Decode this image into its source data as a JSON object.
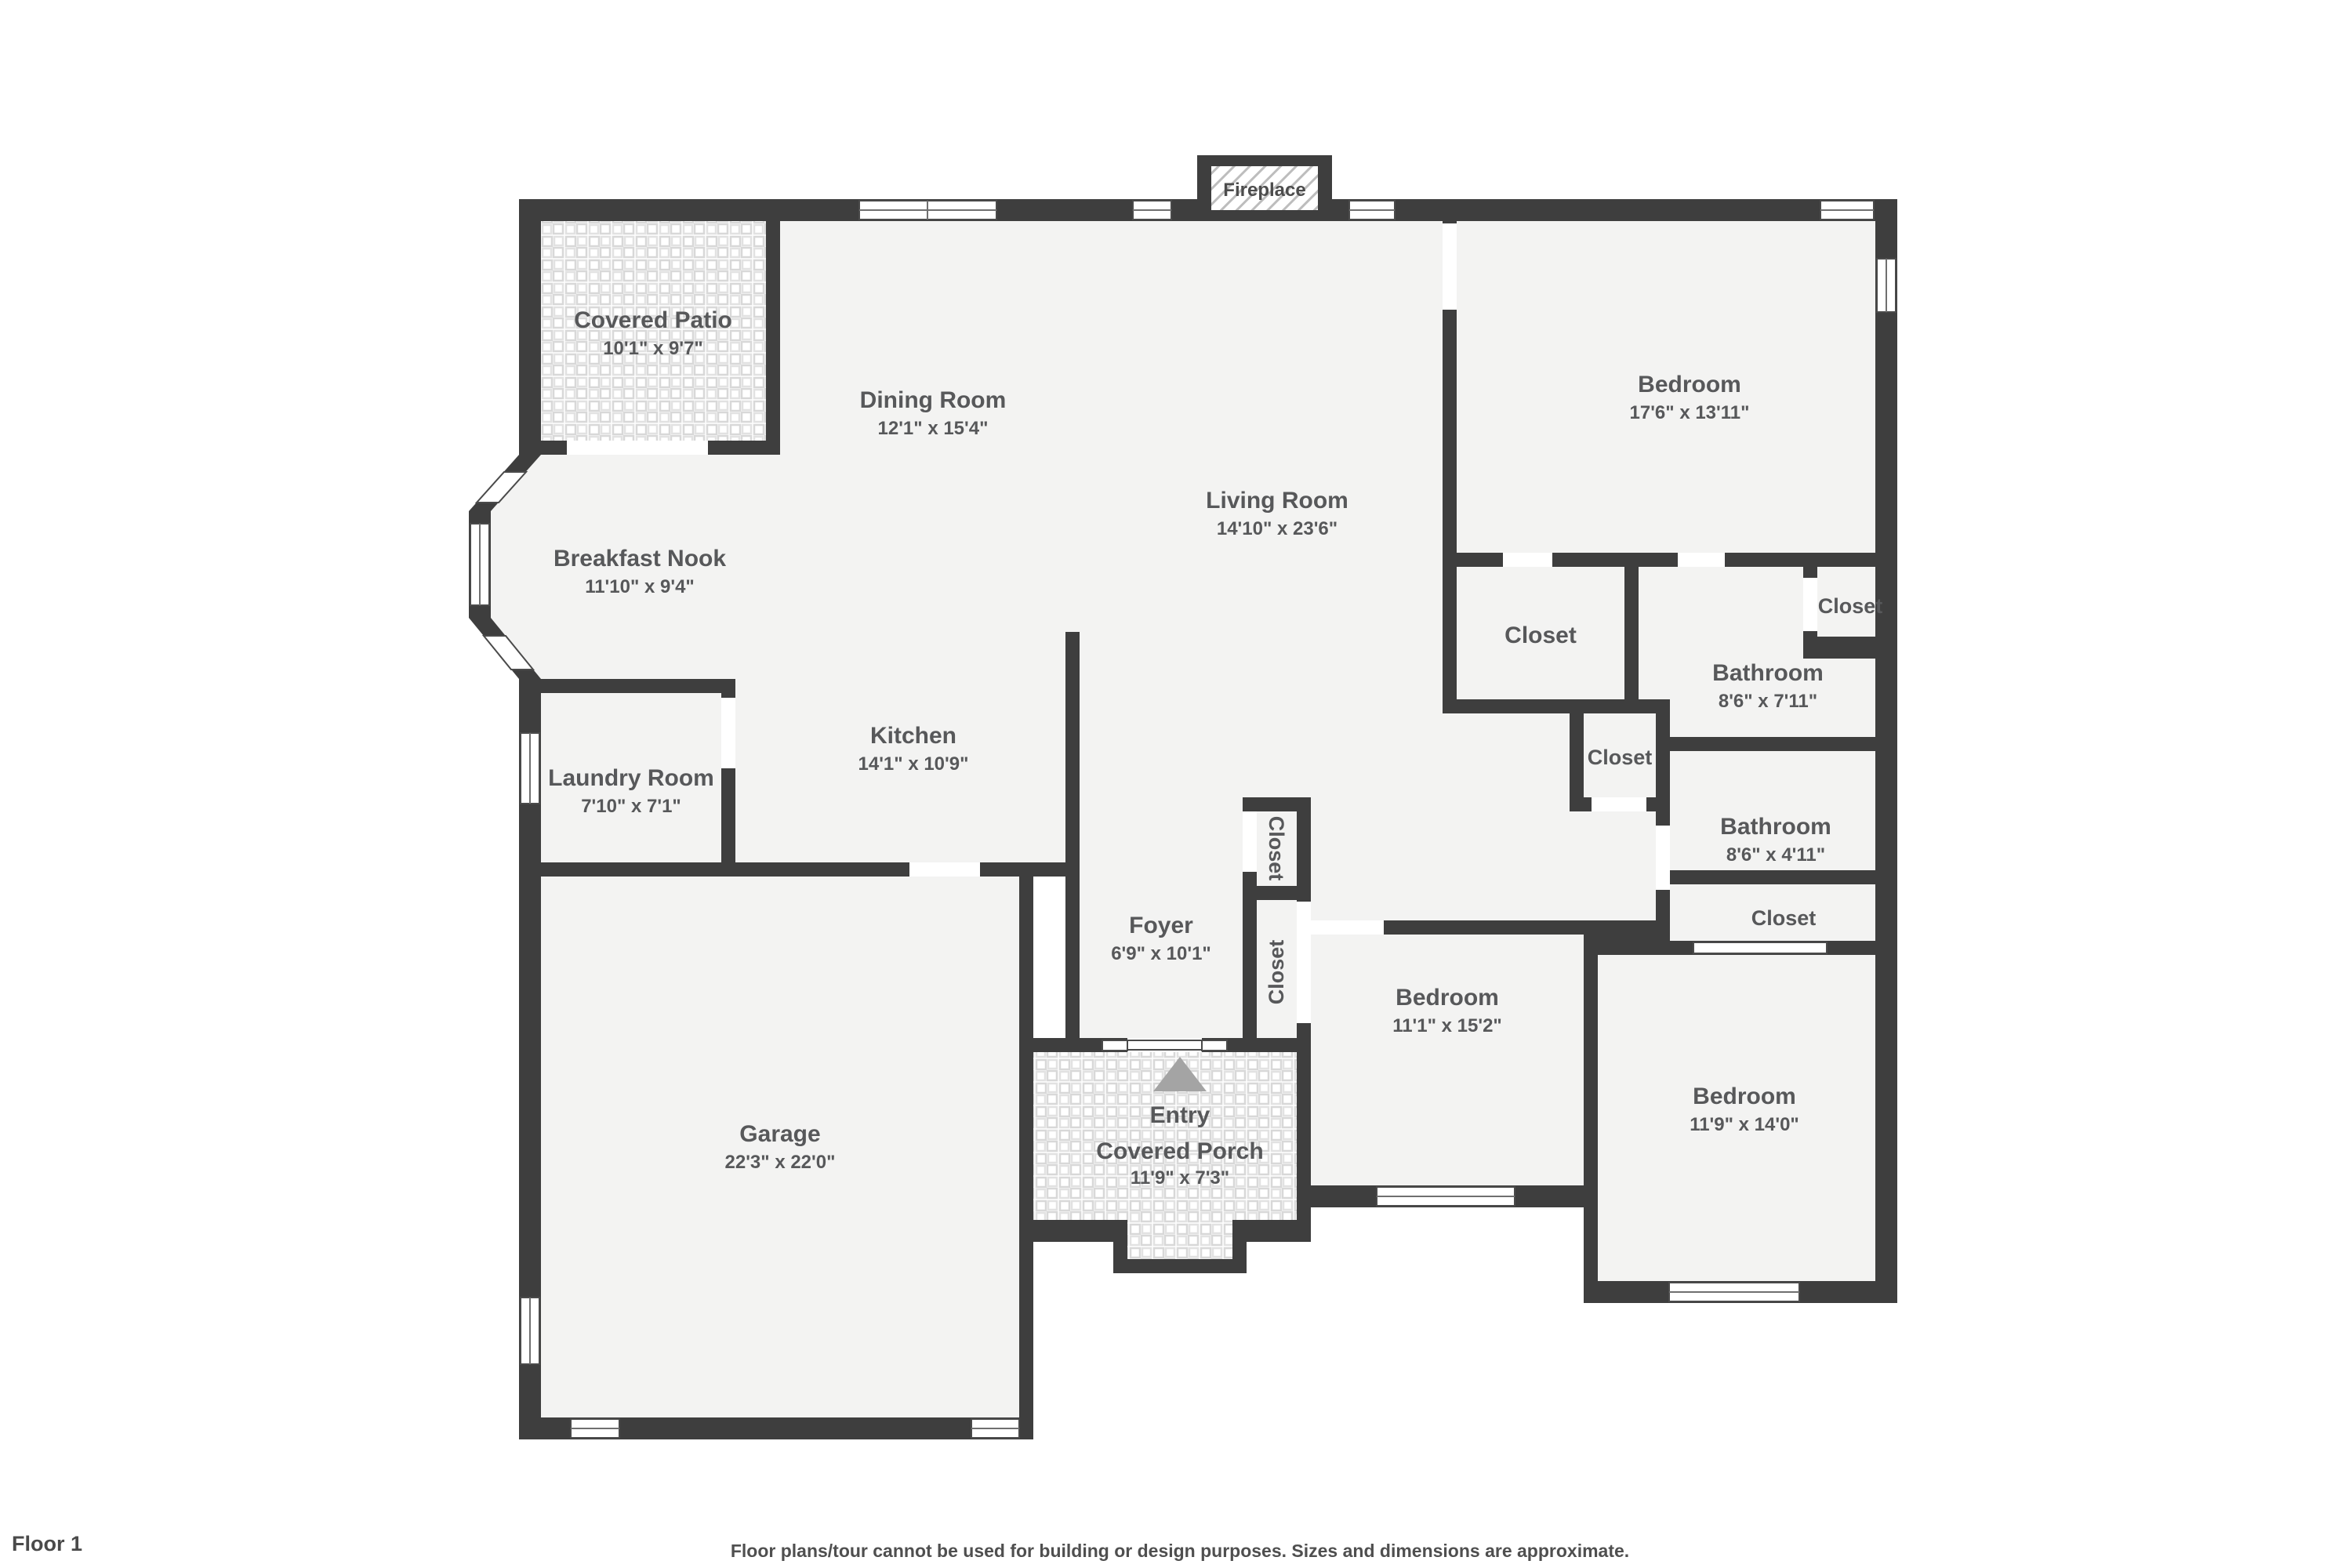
{
  "floor_label": "Floor 1",
  "disclaimer": "Floor plans/tour cannot be used for building or design purposes. Sizes and dimensions are approximate.",
  "colors": {
    "wall": "#3e3e3e",
    "floor": "#f3f3f2",
    "label": "#57585a",
    "arrow": "#a4a4a4"
  },
  "rooms": {
    "covered_patio": {
      "name": "Covered Patio",
      "dims": "10'1\" x 9'7\""
    },
    "dining_room": {
      "name": "Dining Room",
      "dims": "12'1\" x 15'4\""
    },
    "living_room": {
      "name": "Living Room",
      "dims": "14'10\" x 23'6\""
    },
    "bedroom_top_right": {
      "name": "Bedroom",
      "dims": "17'6\" x 13'11\""
    },
    "breakfast_nook": {
      "name": "Breakfast Nook",
      "dims": "11'10\" x 9'4\""
    },
    "closet_master": {
      "name": "Closet"
    },
    "bathroom_master": {
      "name": "Bathroom",
      "dims": "8'6\" x 7'11\""
    },
    "closet_top_right": {
      "name": "Closet"
    },
    "kitchen": {
      "name": "Kitchen",
      "dims": "14'1\" x 10'9\""
    },
    "laundry_room": {
      "name": "Laundry Room",
      "dims": "7'10\" x 7'1\""
    },
    "closet_hall": {
      "name": "Closet"
    },
    "bathroom_hall": {
      "name": "Bathroom",
      "dims": "8'6\" x 4'11\""
    },
    "closet_bedroom_br": {
      "name": "Closet"
    },
    "foyer": {
      "name": "Foyer",
      "dims": "6'9\" x 10'1\""
    },
    "closet_foyer": {
      "name": "Closet"
    },
    "closet_bedroom_mid": {
      "name": "Closet"
    },
    "bedroom_mid": {
      "name": "Bedroom",
      "dims": "11'1\" x 15'2\""
    },
    "bedroom_bottom_right": {
      "name": "Bedroom",
      "dims": "11'9\" x 14'0\""
    },
    "garage": {
      "name": "Garage",
      "dims": "22'3\" x 22'0\""
    },
    "entry": {
      "name": "Entry"
    },
    "covered_porch": {
      "name": "Covered Porch",
      "dims": "11'9\" x 7'3\""
    },
    "fireplace": {
      "name": "Fireplace"
    }
  }
}
